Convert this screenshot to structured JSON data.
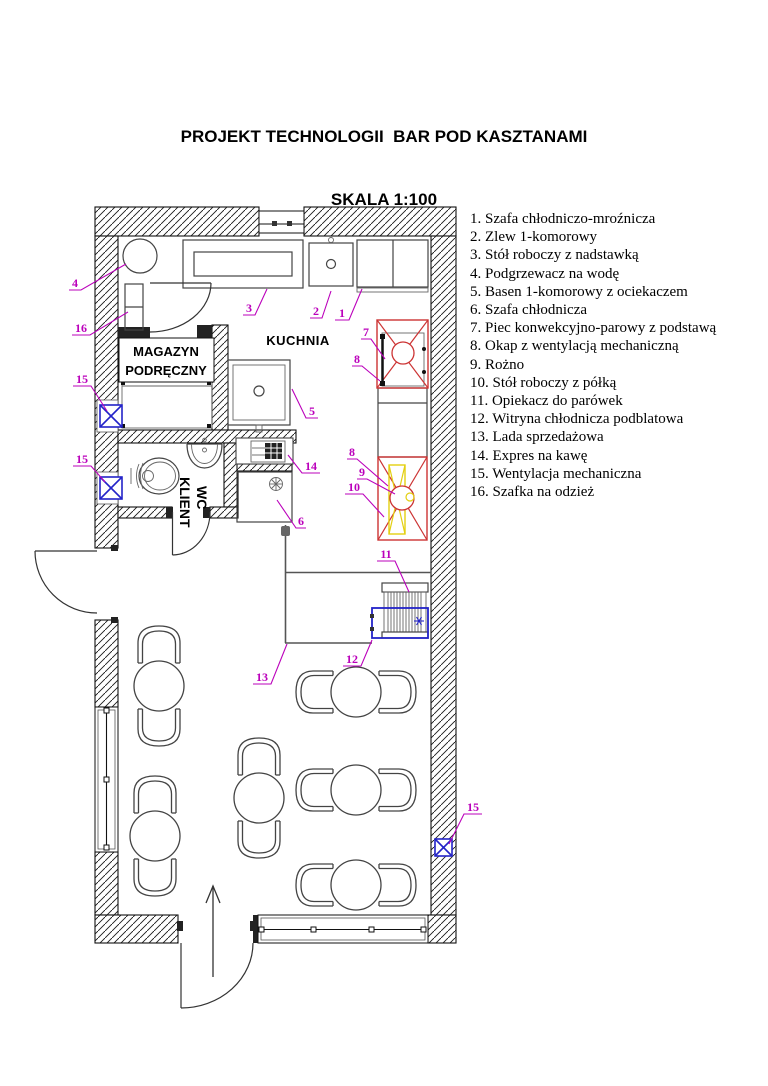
{
  "title": {
    "line1": "PROJEKT TECHNOLOGII  BAR POD KASZTANAMI",
    "line2": "SKALA 1:100"
  },
  "legend": {
    "items": [
      "1. Szafa chłodniczo-mroźnicza",
      "2. Zlew 1-komorowy",
      "3. Stół roboczy z nadstawką",
      "4. Podgrzewacz na wodę",
      "5. Basen 1-komorowy z ociekaczem",
      "6. Szafa chłodnicza",
      "7. Piec konwekcyjno-parowy z podstawą",
      "8. Okap z wentylacją mechaniczną",
      "9. Rożno",
      "10. Stół roboczy z półką",
      "11. Opiekacz do parówek",
      "12. Witryna chłodnicza podblatowa",
      "13. Lada sprzedażowa",
      "14. Expres na kawę",
      "15. Wentylacja mechaniczna",
      "16. Szafka na odzież"
    ]
  },
  "plan": {
    "labels": {
      "kitchen": "KUCHNIA",
      "storage1": "MAGAZYN",
      "storage2": "PODRĘCZNY",
      "wc1": "WC",
      "wc2": "KLIENT"
    },
    "callouts": [
      {
        "n": "1",
        "x": 342,
        "y": 317,
        "w": 14,
        "tx": 362,
        "ty": 289
      },
      {
        "n": "2",
        "x": 316,
        "y": 315,
        "w": 12,
        "tx": 331,
        "ty": 291
      },
      {
        "n": "3",
        "x": 249,
        "y": 312,
        "w": 12,
        "tx": 267,
        "ty": 289
      },
      {
        "n": "4",
        "x": 75,
        "y": 287,
        "w": 12,
        "tx": 126,
        "ty": 264
      },
      {
        "n": "5",
        "x": 312,
        "y": 415,
        "w": 12,
        "tx": 292,
        "ty": 389
      },
      {
        "n": "6",
        "x": 301,
        "y": 525,
        "w": 10,
        "tx": 277,
        "ty": 500
      },
      {
        "n": "7",
        "x": 366,
        "y": 336,
        "w": 10,
        "tx": 385,
        "ty": 359
      },
      {
        "n": "8",
        "x": 357,
        "y": 363,
        "w": 10,
        "tx": 380,
        "ty": 381
      },
      {
        "n": "8",
        "x": 352,
        "y": 456,
        "w": 10,
        "tx": 388,
        "ty": 486
      },
      {
        "n": "9",
        "x": 362,
        "y": 476,
        "w": 10,
        "tx": 395,
        "ty": 494
      },
      {
        "n": "10",
        "x": 354,
        "y": 491,
        "w": 18,
        "tx": 384,
        "ty": 517
      },
      {
        "n": "11",
        "x": 386,
        "y": 558,
        "w": 18,
        "tx": 409,
        "ty": 592
      },
      {
        "n": "12",
        "x": 352,
        "y": 663,
        "w": 18,
        "tx": 372,
        "ty": 640
      },
      {
        "n": "13",
        "x": 262,
        "y": 681,
        "w": 18,
        "tx": 287,
        "ty": 644
      },
      {
        "n": "14",
        "x": 311,
        "y": 470,
        "w": 18,
        "tx": 288,
        "ty": 455
      },
      {
        "n": "15",
        "x": 82,
        "y": 383,
        "w": 18,
        "tx": 107,
        "ty": 411
      },
      {
        "n": "15",
        "x": 82,
        "y": 463,
        "w": 18,
        "tx": 105,
        "ty": 482
      },
      {
        "n": "15",
        "x": 473,
        "y": 811,
        "w": 18,
        "tx": 449,
        "ty": 844
      },
      {
        "n": "16",
        "x": 81,
        "y": 332,
        "w": 18,
        "tx": 128,
        "ty": 312
      }
    ],
    "furniture": {
      "table_radius": 25,
      "chair_offset": 38,
      "tables": [
        {
          "cx": 159,
          "cy": 686,
          "o": "v"
        },
        {
          "cx": 155,
          "cy": 836,
          "o": "v"
        },
        {
          "cx": 259,
          "cy": 798,
          "o": "v"
        },
        {
          "cx": 356,
          "cy": 692,
          "o": "h"
        },
        {
          "cx": 356,
          "cy": 790,
          "o": "h"
        },
        {
          "cx": 356,
          "cy": 885,
          "o": "h"
        }
      ]
    }
  },
  "colors": {
    "callout": "#bb00bb",
    "vent_blue": "#2323c8",
    "equip_red": "#cc3333",
    "equip_yellow": "#e3cf10"
  }
}
